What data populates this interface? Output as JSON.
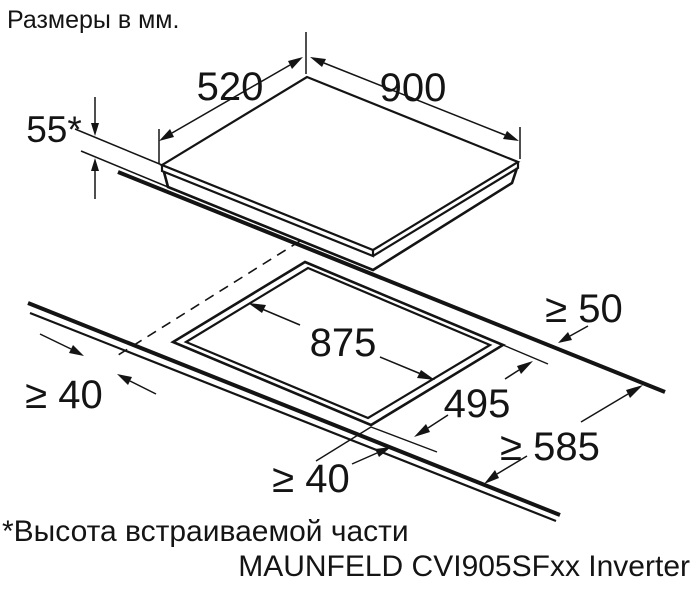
{
  "title": "Размеры в мм.",
  "footnote": "*Высота встраиваемой части",
  "model": "MAUNFELD CVI905SFxx Inverter",
  "dimensions": {
    "hob_width": "900",
    "hob_depth": "520",
    "built_in_height": "55*",
    "cutout_width": "875",
    "cutout_depth": "495",
    "clearance_rear": "≥ 50",
    "clearance_left": "≥ 40",
    "clearance_front": "≥ 40",
    "worktop_min_depth": "≥ 585"
  }
}
